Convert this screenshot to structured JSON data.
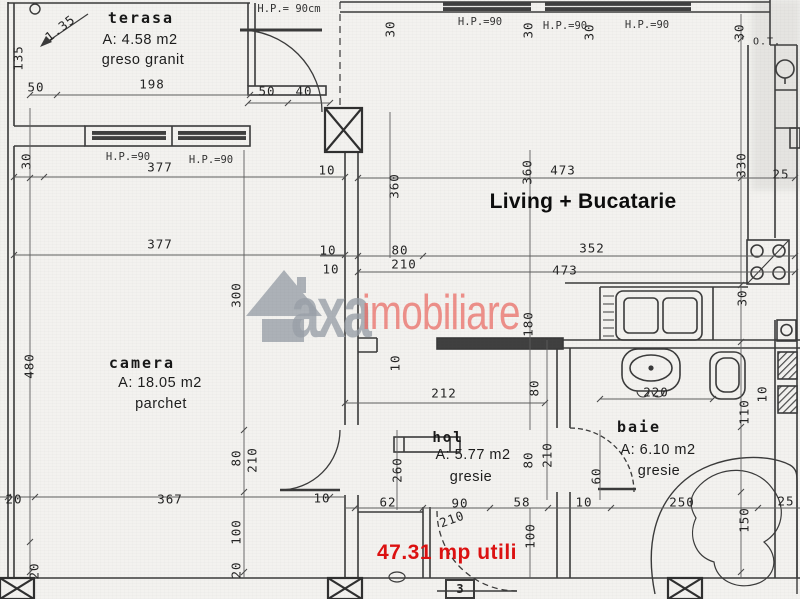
{
  "rooms": {
    "terasa": {
      "name": "terasa",
      "area": "A: 4.58 m2",
      "floor": "greso granit"
    },
    "camera": {
      "name": "camera",
      "area": "A: 18.05 m2",
      "floor": "parchet"
    },
    "living": {
      "name": "Living + Bucatarie"
    },
    "hol": {
      "name": "hol",
      "area": "A: 5.77 m2",
      "floor": "gresie"
    },
    "baie": {
      "name": "baie",
      "area": "A: 6.10 m2",
      "floor": "gresie"
    }
  },
  "annotations": {
    "total_area": "47.31 mp utili",
    "total_color": "#dd1010",
    "door_number": "3",
    "boiler_label": "O.T."
  },
  "watermark": {
    "brand_gray": "axa",
    "brand_red": "imobiliare",
    "gray": "#99a0a8",
    "red": "#ec6a63"
  },
  "dims": [
    {
      "t": "H.P.= 90cm",
      "x": 289,
      "y": 9,
      "s": 1
    },
    {
      "t": "H.P.=90",
      "x": 480,
      "y": 22,
      "s": 1
    },
    {
      "t": "H.P.=90",
      "x": 565,
      "y": 26,
      "s": 1
    },
    {
      "t": "H.P.=90",
      "x": 647,
      "y": 25,
      "s": 1
    },
    {
      "t": "H.P.=90",
      "x": 128,
      "y": 157,
      "s": 1
    },
    {
      "t": "H.P.=90",
      "x": 211,
      "y": 160,
      "s": 1
    },
    {
      "t": "1.35",
      "x": 60,
      "y": 28,
      "r": -38
    },
    {
      "t": "135",
      "x": 18,
      "y": 58,
      "r": -90
    },
    {
      "t": "50",
      "x": 36,
      "y": 87
    },
    {
      "t": "198",
      "x": 152,
      "y": 84
    },
    {
      "t": "50",
      "x": 267,
      "y": 91
    },
    {
      "t": "40",
      "x": 304,
      "y": 91
    },
    {
      "t": "30",
      "x": 390,
      "y": 29,
      "r": -90
    },
    {
      "t": "30",
      "x": 528,
      "y": 30,
      "r": -90
    },
    {
      "t": "30",
      "x": 589,
      "y": 32,
      "r": -90
    },
    {
      "t": "30",
      "x": 739,
      "y": 32,
      "r": -90
    },
    {
      "t": "30",
      "x": 26,
      "y": 161,
      "r": -90
    },
    {
      "t": "377",
      "x": 160,
      "y": 167
    },
    {
      "t": "10",
      "x": 327,
      "y": 170
    },
    {
      "t": "360",
      "x": 394,
      "y": 186,
      "r": -90
    },
    {
      "t": "473",
      "x": 563,
      "y": 170
    },
    {
      "t": "360",
      "x": 527,
      "y": 172,
      "r": -90
    },
    {
      "t": "330",
      "x": 741,
      "y": 165,
      "r": -90
    },
    {
      "t": "25",
      "x": 781,
      "y": 174
    },
    {
      "t": "377",
      "x": 160,
      "y": 244
    },
    {
      "t": "10",
      "x": 328,
      "y": 250
    },
    {
      "t": "80",
      "x": 400,
      "y": 250
    },
    {
      "t": "210",
      "x": 404,
      "y": 264
    },
    {
      "t": "10",
      "x": 331,
      "y": 269
    },
    {
      "t": "352",
      "x": 592,
      "y": 248
    },
    {
      "t": "473",
      "x": 565,
      "y": 270
    },
    {
      "t": "300",
      "x": 236,
      "y": 295,
      "r": -90
    },
    {
      "t": "480",
      "x": 29,
      "y": 366,
      "r": -90
    },
    {
      "t": "30",
      "x": 742,
      "y": 298,
      "r": -90
    },
    {
      "t": "220",
      "x": 656,
      "y": 392
    },
    {
      "t": "110",
      "x": 744,
      "y": 412,
      "r": -90
    },
    {
      "t": "10",
      "x": 762,
      "y": 394,
      "r": -90
    },
    {
      "t": "212",
      "x": 444,
      "y": 393
    },
    {
      "t": "10",
      "x": 395,
      "y": 363,
      "r": -90
    },
    {
      "t": "180",
      "x": 528,
      "y": 324,
      "r": -90
    },
    {
      "t": "80",
      "x": 534,
      "y": 388,
      "r": -90
    },
    {
      "t": "210",
      "x": 547,
      "y": 455,
      "r": -90
    },
    {
      "t": "80",
      "x": 528,
      "y": 460,
      "r": -90
    },
    {
      "t": "260",
      "x": 397,
      "y": 470,
      "r": -90
    },
    {
      "t": "60",
      "x": 596,
      "y": 476,
      "r": -90
    },
    {
      "t": "80",
      "x": 236,
      "y": 458,
      "r": -90
    },
    {
      "t": "210",
      "x": 252,
      "y": 460,
      "r": -90
    },
    {
      "t": "20",
      "x": 14,
      "y": 499
    },
    {
      "t": "367",
      "x": 170,
      "y": 499
    },
    {
      "t": "10",
      "x": 322,
      "y": 498
    },
    {
      "t": "62",
      "x": 388,
      "y": 502
    },
    {
      "t": "90",
      "x": 460,
      "y": 503
    },
    {
      "t": "58",
      "x": 522,
      "y": 502
    },
    {
      "t": "10",
      "x": 584,
      "y": 502
    },
    {
      "t": "250",
      "x": 682,
      "y": 502
    },
    {
      "t": "25",
      "x": 786,
      "y": 501
    },
    {
      "t": "210",
      "x": 452,
      "y": 519,
      "r": -20
    },
    {
      "t": "100",
      "x": 530,
      "y": 536,
      "r": -90
    },
    {
      "t": "150",
      "x": 744,
      "y": 520,
      "r": -90
    },
    {
      "t": "100",
      "x": 236,
      "y": 532,
      "r": -90
    },
    {
      "t": "20",
      "x": 34,
      "y": 571,
      "r": -90
    },
    {
      "t": "20",
      "x": 236,
      "y": 570,
      "r": -90
    }
  ]
}
